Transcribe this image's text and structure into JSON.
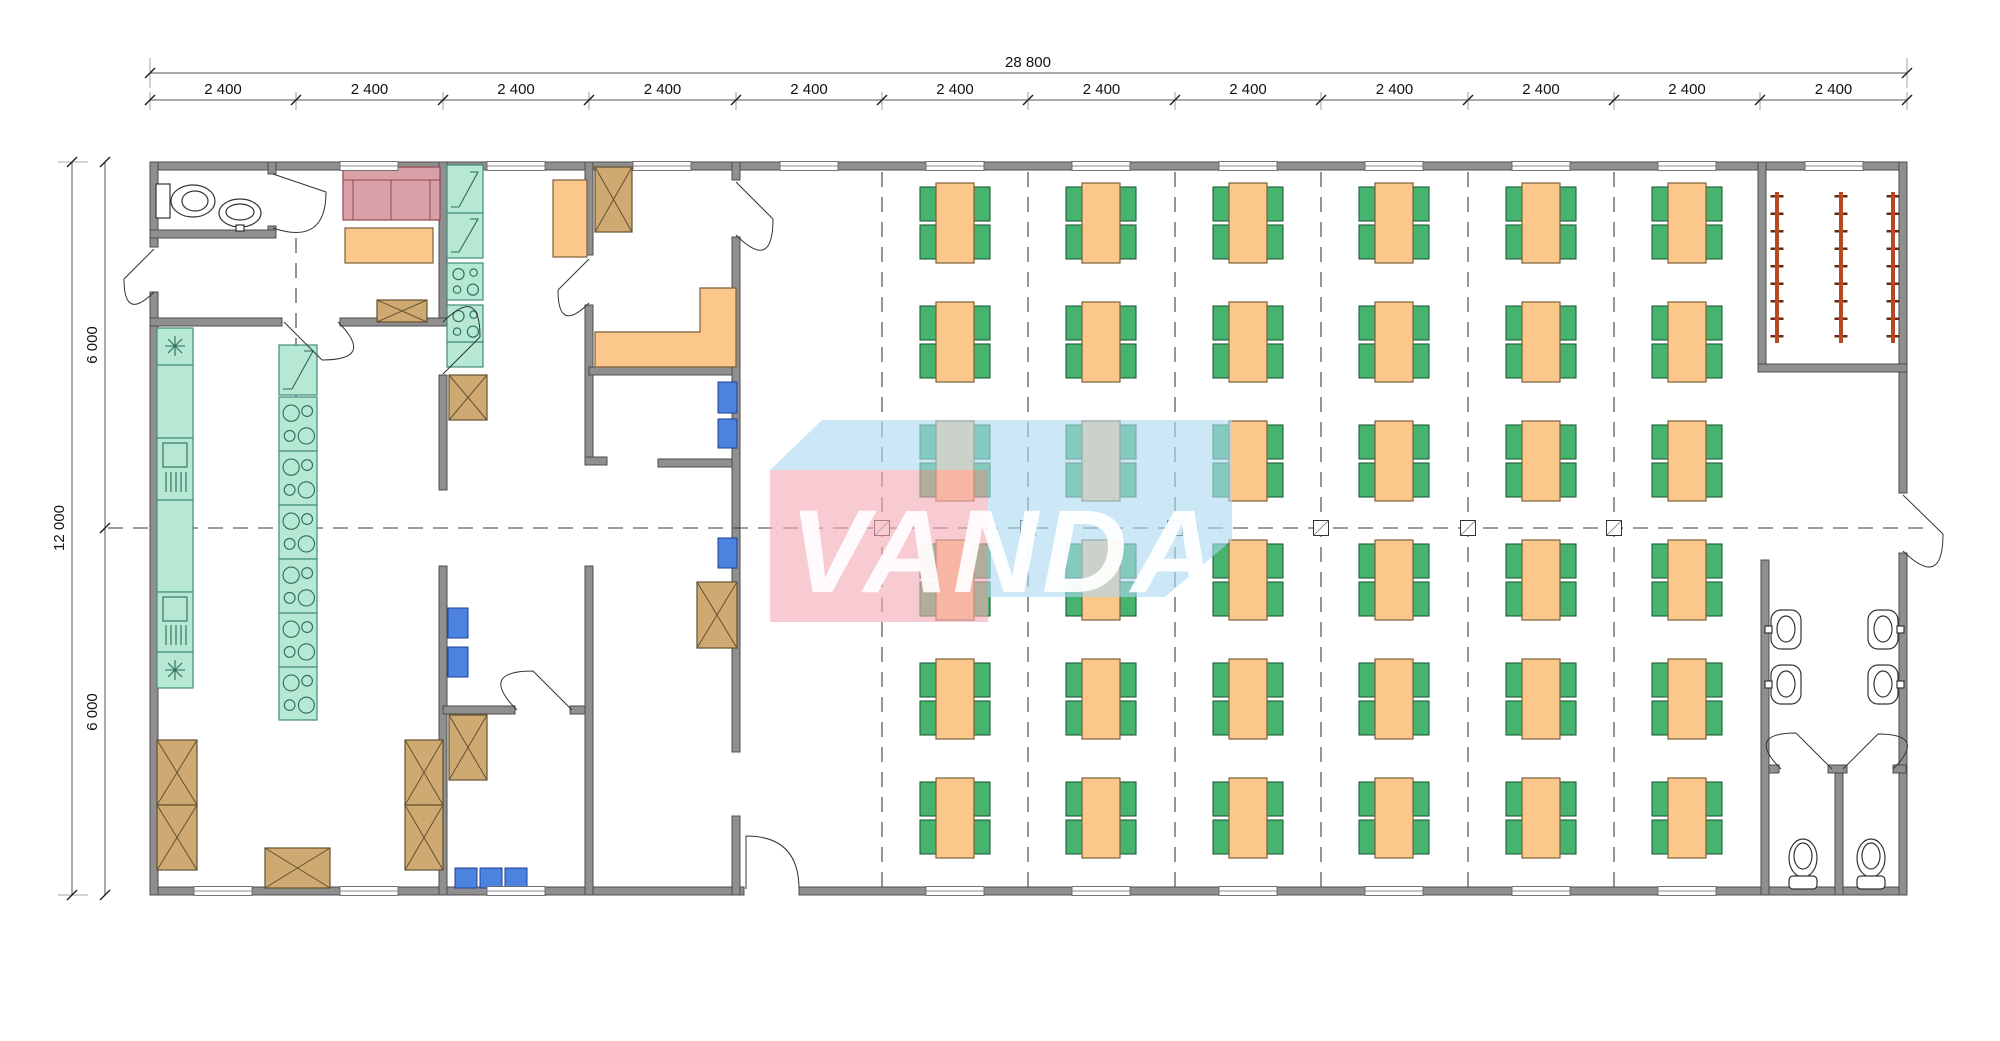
{
  "watermark": {
    "text": "VANDA"
  },
  "dimensions": {
    "overall_width": "28 800",
    "overall_height": "12 000",
    "top_segments": [
      "2 400",
      "2 400",
      "2 400",
      "2 400",
      "2 400",
      "2 400",
      "2 400",
      "2 400",
      "2 400",
      "2 400",
      "2 400",
      "2 400"
    ],
    "left_segments": [
      "6 000",
      "6 000"
    ]
  },
  "dining": {
    "table_columns": 6,
    "table_rows": 6,
    "tables_total": 36,
    "chairs_per_table": 4
  },
  "rooms": {
    "wardrobe_racks": 3,
    "washroom_sinks": 4,
    "wc_stalls": 2
  },
  "colors": {
    "wall": "#8f8f8f",
    "table": "#fbc78a",
    "chair": "#46b46e",
    "counter_teal": "#b6e8d4",
    "cabinet_tan": "#cfa972",
    "seat_blue": "#4d83e0",
    "sofa_pink": "#d9a0a8",
    "rack_red": "#b5491f",
    "watermark_pink": "#f4aab4",
    "watermark_blue": "#add8f0"
  }
}
